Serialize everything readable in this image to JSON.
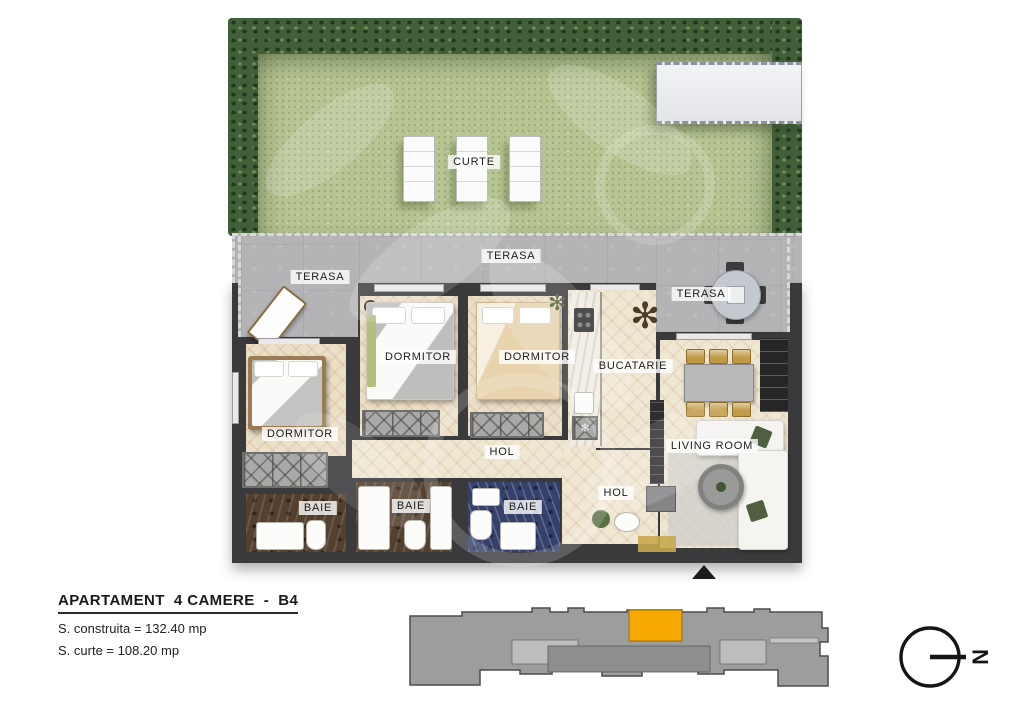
{
  "title_block": {
    "title": "APARTAMENT  4 CAMERE  -  B4",
    "area_built": "S. construita = 132.40 mp",
    "area_yard": "S. curte = 108.20 mp"
  },
  "garden": {
    "label": "CURTE"
  },
  "rooms": {
    "terasa": [
      "TERASA",
      "TERASA",
      "TERASA"
    ],
    "dormitor": [
      "DORMITOR",
      "DORMITOR",
      "DORMITOR"
    ],
    "bucatarie": "BUCATARIE",
    "hol": [
      "HOL",
      "HOL"
    ],
    "baie": [
      "BAIE",
      "BAIE",
      "BAIE"
    ],
    "living_room": "LIVING ROOM"
  },
  "kitchen": {
    "freezer_icon": "❄"
  },
  "compass": {
    "north_letter": "N"
  },
  "colors": {
    "unit_highlight": "#F6A800",
    "building_gray": "#9d9d9d",
    "wall": "#3a3a3c",
    "grass": "#b7c593",
    "hedge": "#41603a"
  }
}
